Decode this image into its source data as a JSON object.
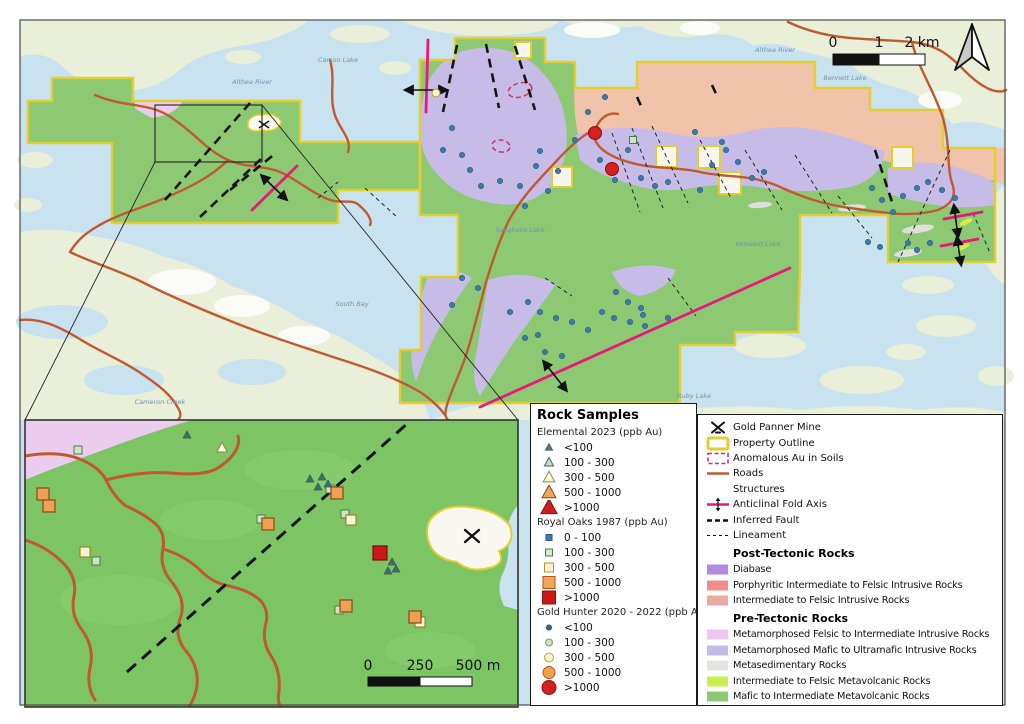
{
  "colors": {
    "water": "#c9e2f0",
    "land": "#e9efd9",
    "white_patch": "#fbfcf7",
    "prop_green": "#8dc873",
    "inset_green": "#7dc465",
    "yellow": "#e3ce2e",
    "salmon": "#f1c3ab",
    "lavender": "#c7bce8",
    "pink_rock": "#ecccee",
    "gray_rock": "#dededa",
    "yellow_green": "#d2ef45",
    "road": "#c05a2e",
    "fold": "#e8187c",
    "anomaly_line": "#d63060",
    "blue_dot": "#3c7aa5"
  },
  "map": {
    "scalebar_main": {
      "t0": "0",
      "t1": "1",
      "t2": "2 km"
    },
    "scalebar_inset": {
      "t0": "0",
      "t1": "250",
      "t2": "500 m"
    },
    "labels": [
      {
        "text": "Carson Lake",
        "x": 338,
        "y": 62
      },
      {
        "text": "Althea River",
        "x": 252,
        "y": 84
      },
      {
        "text": "Althea River",
        "x": 775,
        "y": 52
      },
      {
        "text": "Bennett Lake",
        "x": 845,
        "y": 80
      },
      {
        "text": "Songhans Lake",
        "x": 520,
        "y": 232
      },
      {
        "text": "Kenwest Lake",
        "x": 758,
        "y": 246
      },
      {
        "text": "South Bay",
        "x": 352,
        "y": 306
      },
      {
        "text": "Cameron Creek",
        "x": 160,
        "y": 404
      },
      {
        "text": "Ruby Lake",
        "x": 694,
        "y": 398
      }
    ],
    "exclusions": [
      [
        515,
        42,
        16
      ],
      [
        552,
        167,
        20
      ],
      [
        656,
        146,
        21
      ],
      [
        698,
        146,
        22
      ],
      [
        719,
        172,
        22
      ],
      [
        892,
        147,
        21
      ]
    ],
    "anomalies": [
      [
        520,
        90,
        12,
        7,
        -15
      ],
      [
        501,
        146,
        9,
        6,
        10
      ]
    ],
    "samples_main": {
      "blue_dots": [
        [
          452,
          128
        ],
        [
          462,
          155
        ],
        [
          443,
          150
        ],
        [
          470,
          170
        ],
        [
          481,
          186
        ],
        [
          500,
          181
        ],
        [
          520,
          186
        ],
        [
          536,
          166
        ],
        [
          548,
          191
        ],
        [
          525,
          206
        ],
        [
          558,
          171
        ],
        [
          540,
          151
        ],
        [
          605,
          97
        ],
        [
          588,
          112
        ],
        [
          575,
          140
        ],
        [
          600,
          160
        ],
        [
          615,
          180
        ],
        [
          628,
          150
        ],
        [
          641,
          178
        ],
        [
          655,
          186
        ],
        [
          668,
          182
        ],
        [
          700,
          190
        ],
        [
          712,
          165
        ],
        [
          726,
          150
        ],
        [
          738,
          162
        ],
        [
          752,
          178
        ],
        [
          764,
          172
        ],
        [
          695,
          132
        ],
        [
          722,
          142
        ],
        [
          872,
          188
        ],
        [
          882,
          200
        ],
        [
          893,
          212
        ],
        [
          903,
          196
        ],
        [
          917,
          188
        ],
        [
          928,
          182
        ],
        [
          942,
          190
        ],
        [
          955,
          198
        ],
        [
          930,
          243
        ],
        [
          917,
          250
        ],
        [
          880,
          247
        ],
        [
          868,
          242
        ],
        [
          908,
          243
        ],
        [
          462,
          278
        ],
        [
          478,
          288
        ],
        [
          452,
          305
        ],
        [
          510,
          312
        ],
        [
          528,
          302
        ],
        [
          540,
          312
        ],
        [
          556,
          318
        ],
        [
          572,
          322
        ],
        [
          588,
          330
        ],
        [
          602,
          312
        ],
        [
          614,
          318
        ],
        [
          630,
          322
        ],
        [
          645,
          326
        ],
        [
          628,
          302
        ],
        [
          616,
          292
        ],
        [
          545,
          352
        ],
        [
          562,
          356
        ],
        [
          525,
          338
        ],
        [
          668,
          318
        ],
        [
          538,
          335
        ],
        [
          641,
          308
        ],
        [
          643,
          315
        ]
      ],
      "red_circles": [
        [
          595,
          133
        ],
        [
          612,
          169
        ]
      ],
      "cream_circles": [
        [
          436,
          93
        ]
      ],
      "green_squares": [
        [
          633,
          140
        ]
      ]
    },
    "samples_inset": {
      "orange_squares": [
        [
          43,
          494
        ],
        [
          49,
          506
        ],
        [
          268,
          524
        ],
        [
          337,
          493
        ],
        [
          346,
          606
        ],
        [
          415,
          617
        ]
      ],
      "cream_squares": [
        [
          85,
          552
        ],
        [
          351,
          520
        ],
        [
          420,
          622
        ]
      ],
      "green_squares": [
        [
          78,
          450
        ],
        [
          96,
          561
        ],
        [
          261,
          519
        ],
        [
          330,
          489
        ],
        [
          339,
          610
        ],
        [
          345,
          514
        ]
      ],
      "red_squares": [
        [
          380,
          553
        ]
      ],
      "teal_triangles": [
        [
          187,
          435
        ],
        [
          310,
          479
        ],
        [
          322,
          477
        ],
        [
          328,
          484
        ],
        [
          318,
          487
        ],
        [
          392,
          562
        ],
        [
          396,
          569
        ],
        [
          388,
          571
        ]
      ],
      "white_triangles": [
        [
          222,
          448
        ]
      ]
    }
  },
  "legend_left": {
    "title": "Rock Samples",
    "sections": [
      {
        "label": "Elemental 2023 (ppb Au)",
        "shape": "triangle",
        "items": [
          {
            "range": "<100",
            "size": 6,
            "fill": "#5a7d7d",
            "stroke": "#3f5f5f"
          },
          {
            "range": "100 - 300",
            "size": 8,
            "fill": "#ccd8c3",
            "stroke": "#4a6b5a"
          },
          {
            "range": "300 - 500",
            "size": 10,
            "fill": "#faf7da",
            "stroke": "#8a8a4a"
          },
          {
            "range": "500 - 1000",
            "size": 12,
            "fill": "#f2a55c",
            "stroke": "#7a4a20"
          },
          {
            "range": ">1000",
            "size": 14,
            "fill": "#cc1f1f",
            "stroke": "#8a1010"
          }
        ]
      },
      {
        "label": "Royal Oaks 1987 (ppb Au)",
        "shape": "square",
        "items": [
          {
            "range": "0 - 100",
            "size": 6,
            "fill": "#3d7ba8",
            "stroke": "#2a5a80"
          },
          {
            "range": "100 - 300",
            "size": 7,
            "fill": "#d8e8d0",
            "stroke": "#4a7a4a"
          },
          {
            "range": "300 - 500",
            "size": 9,
            "fill": "#f8f4d0",
            "stroke": "#b09a30"
          },
          {
            "range": "500 - 1000",
            "size": 12,
            "fill": "#f2a55c",
            "stroke": "#b05a10"
          },
          {
            "range": ">1000",
            "size": 13,
            "fill": "#cc1818",
            "stroke": "#8a1010"
          }
        ]
      },
      {
        "label": "Gold Hunter 2020 - 2022 (ppb Au)",
        "shape": "circle",
        "items": [
          {
            "range": "<100",
            "size": 5,
            "fill": "#2f6b8f",
            "stroke": "#1f4b6b"
          },
          {
            "range": "100 - 300",
            "size": 7,
            "fill": "#cfe0c0",
            "stroke": "#7a9a6a"
          },
          {
            "range": "300 - 500",
            "size": 9,
            "fill": "#f8f4d0",
            "stroke": "#c8a030"
          },
          {
            "range": "500 - 1000",
            "size": 12,
            "fill": "#f0a050",
            "stroke": "#b05a10"
          },
          {
            "range": ">1000",
            "size": 14,
            "fill": "#d42020",
            "stroke": "#901010"
          }
        ]
      }
    ]
  },
  "legend_right": {
    "items": [
      {
        "sym": "mine",
        "label": "Gold Panner Mine"
      },
      {
        "sym": "property",
        "label": "Property Outline"
      },
      {
        "sym": "anomaly",
        "label": "Anomalous Au in Soils"
      },
      {
        "sym": "road",
        "label": "Roads"
      },
      {
        "sym": "none",
        "label": "Structures"
      },
      {
        "sym": "fold",
        "label": "Anticlinal Fold Axis"
      },
      {
        "sym": "fault",
        "label": "Inferred Fault"
      },
      {
        "sym": "lineament",
        "label": "Lineament"
      }
    ],
    "post_header": "Post-Tectonic Rocks",
    "post_items": [
      {
        "label": "Diabase",
        "color": "#b28ae0"
      },
      {
        "label": "Porphyritic Intermediate to Felsic Intrusive Rocks",
        "color": "#f28b8b"
      },
      {
        "label": "Intermediate to Felsic Intrusive Rocks",
        "color": "#e9aaa4"
      }
    ],
    "pre_header": "Pre-Tectonic Rocks",
    "pre_items": [
      {
        "label": "Metamorphosed Felsic to Intermediate Intrusive Rocks",
        "color": "#ecc6ef"
      },
      {
        "label": "Metamorphosed Mafic to Ultramafic Intrusive Rocks",
        "color": "#c5bbe9"
      },
      {
        "label": "Metasedimentary Rocks",
        "color": "#e3e3df"
      },
      {
        "label": "Intermediate to Felsic Metavolcanic Rocks",
        "color": "#c8f04a"
      },
      {
        "label": "Mafic to Intermediate Metavolcanic Rocks",
        "color": "#8dc873"
      }
    ]
  }
}
